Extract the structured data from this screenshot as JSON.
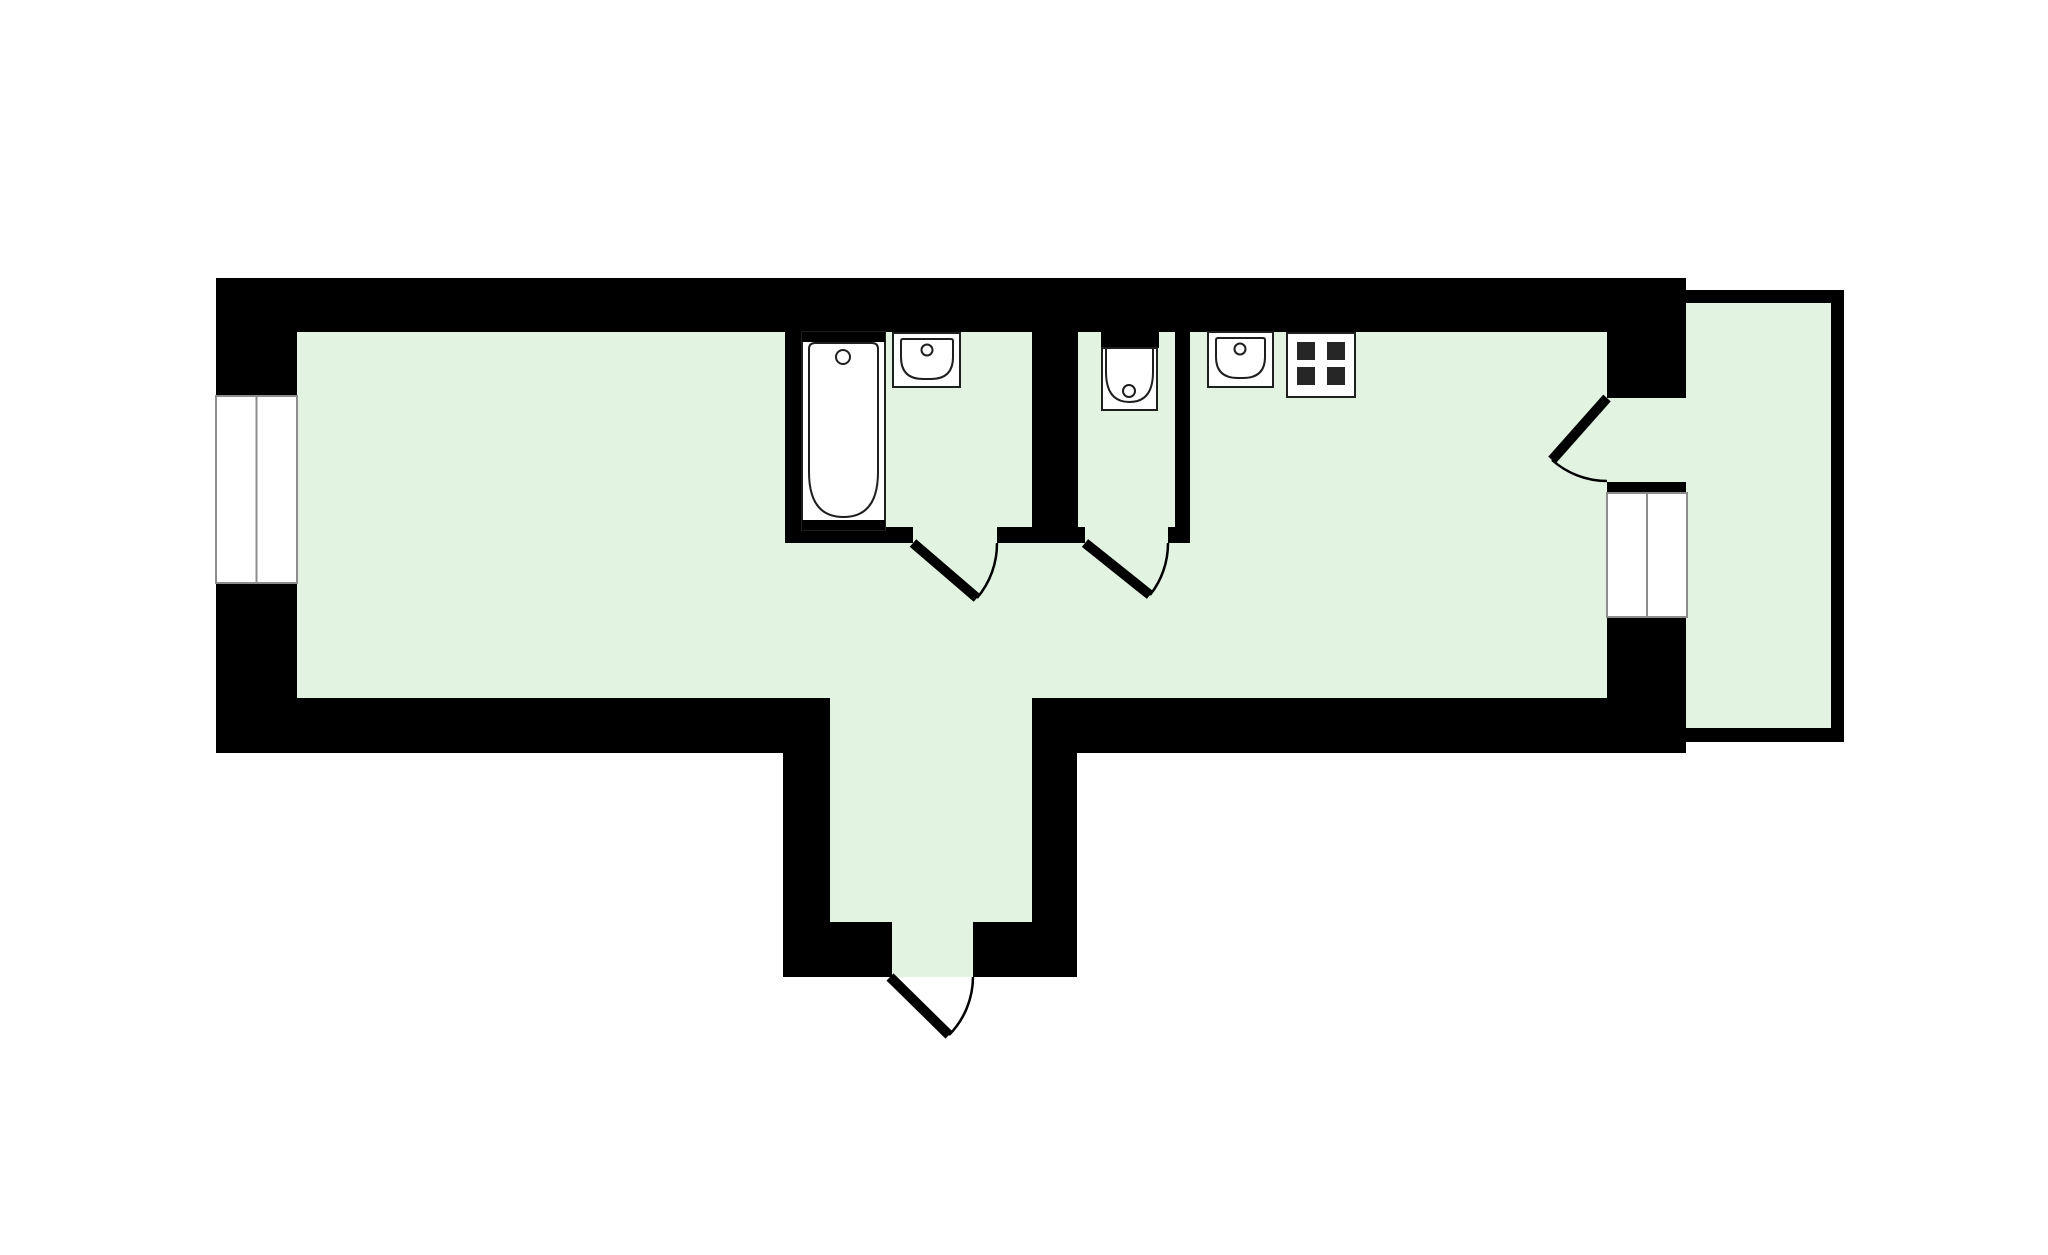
{
  "canvas": {
    "width": 2048,
    "height": 1255,
    "background": "#ffffff"
  },
  "palette": {
    "wall": "#000000",
    "floor": "#e2f4e1",
    "fixture": "#ffffff",
    "ink": "#1f1f1f",
    "frame": "#8c8c8c",
    "door": "#000000",
    "burner": "#262626"
  },
  "elements": [
    {
      "name": "apartment-floor",
      "kind": "path",
      "d": "M297,332 H1607 V698 H1032 V922 H973 V977 H892 V922 H830 V698 H297 Z",
      "fill": "floor"
    },
    {
      "name": "balcony-doorway-floor",
      "kind": "rect",
      "x": 1607,
      "y": 398,
      "w": 83,
      "h": 84,
      "fill": "floor"
    },
    {
      "name": "balcony-floor",
      "kind": "rect",
      "x": 1686,
      "y": 303,
      "w": 145,
      "h": 425,
      "fill": "floor"
    },
    {
      "name": "top-wall",
      "kind": "rect",
      "x": 216,
      "y": 278,
      "w": 1470,
      "h": 54,
      "fill": "wall"
    },
    {
      "name": "left-wall-upper",
      "kind": "rect",
      "x": 216,
      "y": 278,
      "w": 81,
      "h": 118,
      "fill": "wall"
    },
    {
      "name": "left-wall-lower",
      "kind": "rect",
      "x": 216,
      "y": 583,
      "w": 81,
      "h": 170,
      "fill": "wall"
    },
    {
      "name": "bottom-wall-left",
      "kind": "rect",
      "x": 216,
      "y": 698,
      "w": 614,
      "h": 55,
      "fill": "wall"
    },
    {
      "name": "bottom-wall-right",
      "kind": "rect",
      "x": 1032,
      "y": 698,
      "w": 654,
      "h": 55,
      "fill": "wall"
    },
    {
      "name": "right-wall-upper",
      "kind": "rect",
      "x": 1607,
      "y": 278,
      "w": 79,
      "h": 120,
      "fill": "wall"
    },
    {
      "name": "right-wall-mid",
      "kind": "rect",
      "x": 1607,
      "y": 482,
      "w": 79,
      "h": 11,
      "fill": "wall"
    },
    {
      "name": "right-wall-lower",
      "kind": "rect",
      "x": 1607,
      "y": 617,
      "w": 79,
      "h": 136,
      "fill": "wall"
    },
    {
      "name": "vestibule-wall-left",
      "kind": "rect",
      "x": 783,
      "y": 753,
      "w": 47,
      "h": 224,
      "fill": "wall"
    },
    {
      "name": "vestibule-wall-right",
      "kind": "rect",
      "x": 1032,
      "y": 753,
      "w": 45,
      "h": 224,
      "fill": "wall"
    },
    {
      "name": "vestibule-step-left",
      "kind": "rect",
      "x": 783,
      "y": 922,
      "w": 109,
      "h": 55,
      "fill": "wall"
    },
    {
      "name": "vestibule-step-right",
      "kind": "rect",
      "x": 973,
      "y": 922,
      "w": 104,
      "h": 55,
      "fill": "wall"
    },
    {
      "name": "bathroom-wall-left",
      "kind": "rect",
      "x": 785,
      "y": 332,
      "w": 17,
      "h": 211,
      "fill": "wall"
    },
    {
      "name": "bathroom-wc-wall",
      "kind": "rect",
      "x": 1032,
      "y": 332,
      "w": 46,
      "h": 211,
      "fill": "wall"
    },
    {
      "name": "wc-kitchen-wall",
      "kind": "rect",
      "x": 1175,
      "y": 332,
      "w": 15,
      "h": 211,
      "fill": "wall"
    },
    {
      "name": "bathroom-wall-bottom-left",
      "kind": "rect",
      "x": 785,
      "y": 527,
      "w": 128,
      "h": 16,
      "fill": "wall"
    },
    {
      "name": "bathroom-wall-bottom-right",
      "kind": "rect",
      "x": 997,
      "y": 527,
      "w": 35,
      "h": 16,
      "fill": "wall"
    },
    {
      "name": "wc-wall-bottom-left",
      "kind": "rect",
      "x": 1078,
      "y": 527,
      "w": 7,
      "h": 16,
      "fill": "wall"
    },
    {
      "name": "wc-wall-bottom-right",
      "kind": "rect",
      "x": 1168,
      "y": 527,
      "w": 22,
      "h": 16,
      "fill": "wall"
    },
    {
      "name": "toilet-niche-wall",
      "kind": "rect",
      "x": 1101,
      "y": 332,
      "w": 58,
      "h": 16,
      "fill": "wall"
    },
    {
      "name": "balcony-wall-top",
      "kind": "rect",
      "x": 1686,
      "y": 290,
      "w": 158,
      "h": 13,
      "fill": "wall"
    },
    {
      "name": "balcony-wall-right",
      "kind": "rect",
      "x": 1831,
      "y": 290,
      "w": 13,
      "h": 452,
      "fill": "wall"
    },
    {
      "name": "balcony-wall-bottom",
      "kind": "rect",
      "x": 1686,
      "y": 728,
      "w": 158,
      "h": 14,
      "fill": "wall"
    },
    {
      "name": "living-room-window",
      "kind": "rect",
      "x": 216,
      "y": 396,
      "w": 81,
      "h": 187,
      "fill": "fixture",
      "stroke": "frame",
      "sw": 2
    },
    {
      "name": "living-room-window-mullion",
      "kind": "line",
      "x1": 256.5,
      "y1": 396,
      "x2": 256.5,
      "y2": 583,
      "stroke": "frame",
      "sw": 2
    },
    {
      "name": "balcony-window",
      "kind": "rect",
      "x": 1607,
      "y": 493,
      "w": 80,
      "h": 124,
      "fill": "fixture",
      "stroke": "frame",
      "sw": 2
    },
    {
      "name": "balcony-window-mullion",
      "kind": "line",
      "x1": 1647,
      "y1": 493,
      "x2": 1647,
      "y2": 617,
      "stroke": "frame",
      "sw": 2
    },
    {
      "name": "bathroom-door-leaf",
      "kind": "line",
      "x1": 913,
      "y1": 543,
      "x2": 977,
      "y2": 598,
      "stroke": "door",
      "sw": 10
    },
    {
      "name": "bathroom-door-swing",
      "kind": "path",
      "d": "M977,598 A84,84 0 0 0 997,543",
      "fill": "none",
      "stroke": "door",
      "sw": 2.5
    },
    {
      "name": "wc-door-leaf",
      "kind": "line",
      "x1": 1085,
      "y1": 543,
      "x2": 1150,
      "y2": 595,
      "stroke": "door",
      "sw": 10
    },
    {
      "name": "wc-door-swing",
      "kind": "path",
      "d": "M1150,595 A83,83 0 0 0 1168,543",
      "fill": "none",
      "stroke": "door",
      "sw": 2.5
    },
    {
      "name": "entry-door-leaf",
      "kind": "line",
      "x1": 890,
      "y1": 977,
      "x2": 949,
      "y2": 1035,
      "stroke": "door",
      "sw": 10
    },
    {
      "name": "entry-door-swing",
      "kind": "path",
      "d": "M949,1035 A83,83 0 0 0 973,977",
      "fill": "none",
      "stroke": "door",
      "sw": 2.5
    },
    {
      "name": "balcony-door-leaf",
      "kind": "line",
      "x1": 1607,
      "y1": 398,
      "x2": 1552,
      "y2": 460,
      "stroke": "door",
      "sw": 10
    },
    {
      "name": "balcony-door-swing",
      "kind": "path",
      "d": "M1552,460 A83,83 0 0 0 1607,481",
      "fill": "none",
      "stroke": "door",
      "sw": 2.5
    },
    {
      "name": "bathtub-body",
      "kind": "rect",
      "x": 802,
      "y": 332,
      "w": 83,
      "h": 198,
      "fill": "fixture",
      "stroke": "ink",
      "sw": 2
    },
    {
      "name": "bathtub-top-band",
      "kind": "rect",
      "x": 802,
      "y": 332,
      "w": 83,
      "h": 10,
      "fill": "wall"
    },
    {
      "name": "bathtub-bottom-band",
      "kind": "rect",
      "x": 802,
      "y": 520,
      "w": 83,
      "h": 10,
      "fill": "wall"
    },
    {
      "name": "bathtub-basin",
      "kind": "path",
      "d": "M815,343 H872 Q878,343 878,349 V472 Q878,517 843.5,517 Q809,517 809,472 V349 Q809,343 815,343 Z",
      "fill": "fixture",
      "stroke": "ink",
      "sw": 2
    },
    {
      "name": "bathtub-drain",
      "kind": "circle",
      "cx": 843,
      "cy": 357,
      "r": 7,
      "fill": "fixture",
      "stroke": "ink",
      "sw": 2
    },
    {
      "name": "bathroom-sink-body",
      "kind": "rect",
      "x": 893,
      "y": 333,
      "w": 67,
      "h": 54,
      "fill": "fixture",
      "stroke": "ink",
      "sw": 2
    },
    {
      "name": "bathroom-sink-basin",
      "kind": "path",
      "d": "M903,339 H951 Q953,339 953,341 V357 Q953,379 931,379 H923 Q901,379 901,357 V341 Q901,339 903,339 Z",
      "fill": "fixture",
      "stroke": "ink",
      "sw": 2
    },
    {
      "name": "bathroom-sink-faucet",
      "kind": "circle",
      "cx": 927,
      "cy": 350,
      "r": 5.5,
      "fill": "fixture",
      "stroke": "ink",
      "sw": 2
    },
    {
      "name": "toilet-tank",
      "kind": "rect",
      "x": 1102,
      "y": 348,
      "w": 55,
      "h": 62,
      "fill": "fixture",
      "stroke": "ink",
      "sw": 2
    },
    {
      "name": "toilet-bowl",
      "kind": "path",
      "d": "M1106,349 V372 Q1106,402 1129.5,402 Q1153,402 1153,372 V349",
      "fill": "fixture",
      "stroke": "ink",
      "sw": 2
    },
    {
      "name": "toilet-flush-button",
      "kind": "circle",
      "cx": 1129,
      "cy": 391,
      "r": 6,
      "fill": "fixture",
      "stroke": "ink",
      "sw": 2
    },
    {
      "name": "kitchen-sink-body",
      "kind": "rect",
      "x": 1208,
      "y": 332,
      "w": 65,
      "h": 55,
      "fill": "fixture",
      "stroke": "ink",
      "sw": 2
    },
    {
      "name": "kitchen-sink-basin",
      "kind": "path",
      "d": "M1218,338 H1263 Q1265,338 1265,340 V357 Q1265,378 1243,378 H1238 Q1216,378 1216,357 V340 Q1216,338 1218,338 Z",
      "fill": "fixture",
      "stroke": "ink",
      "sw": 2
    },
    {
      "name": "kitchen-sink-faucet",
      "kind": "circle",
      "cx": 1240,
      "cy": 349,
      "r": 5.5,
      "fill": "fixture",
      "stroke": "ink",
      "sw": 2
    },
    {
      "name": "stove-body",
      "kind": "rect",
      "x": 1287,
      "y": 333,
      "w": 68,
      "h": 64,
      "fill": "fixture",
      "stroke": "ink",
      "sw": 2
    },
    {
      "name": "stove-burner-top-left",
      "kind": "rect",
      "x": 1297,
      "y": 342,
      "w": 18,
      "h": 18,
      "fill": "burner"
    },
    {
      "name": "stove-burner-top-right",
      "kind": "rect",
      "x": 1327,
      "y": 342,
      "w": 18,
      "h": 18,
      "fill": "burner"
    },
    {
      "name": "stove-burner-bottom-left",
      "kind": "rect",
      "x": 1297,
      "y": 367,
      "w": 18,
      "h": 18,
      "fill": "burner"
    },
    {
      "name": "stove-burner-bottom-right",
      "kind": "rect",
      "x": 1327,
      "y": 367,
      "w": 18,
      "h": 18,
      "fill": "burner"
    }
  ]
}
